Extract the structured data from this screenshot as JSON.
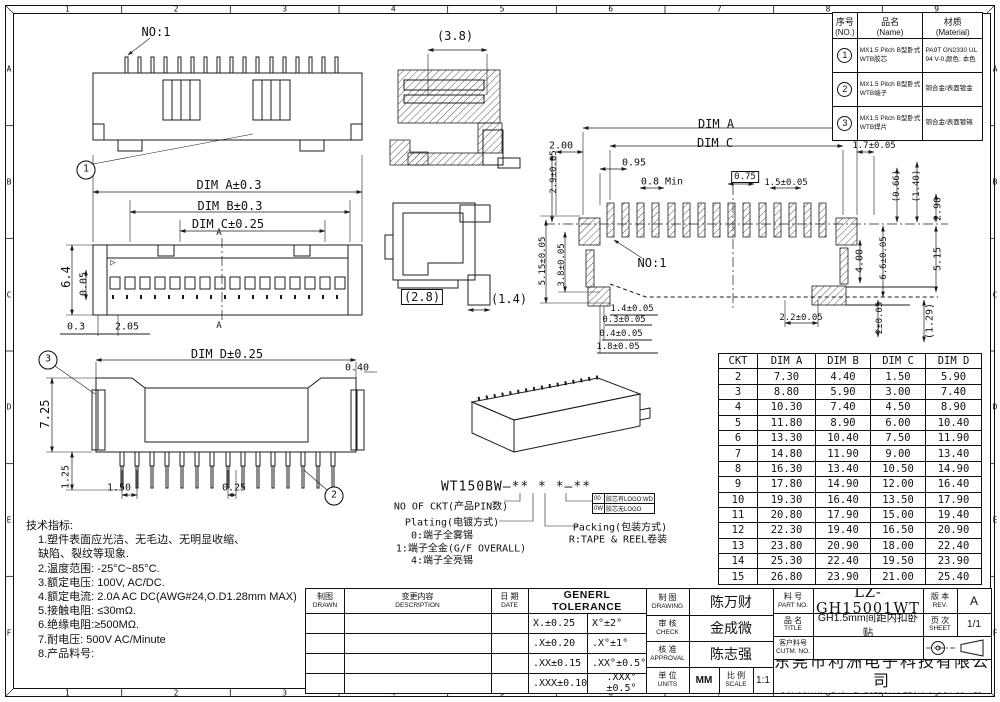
{
  "zones": {
    "cols": [
      "1",
      "2",
      "3",
      "4",
      "5",
      "6",
      "7",
      "8",
      "9"
    ],
    "rows": [
      "A",
      "B",
      "C",
      "D",
      "E",
      "F"
    ]
  },
  "bom": {
    "no_cn": "序号",
    "no_en": "(NO.)",
    "name_cn": "品名",
    "name_en": "(Name)",
    "mat_cn": "材质",
    "mat_en": "(Material)",
    "rows": [
      {
        "no": "1",
        "name": "MX1.5 Pitch B型卧式 WTB胶芯",
        "mat": "PA9T GN2330 UL 94 V-0,颜色: 本色"
      },
      {
        "no": "2",
        "name": "MX1.5 Pitch B型卧式 WTB端子",
        "mat": "铜合金/表面镀金"
      },
      {
        "no": "3",
        "name": "MX1.5 Pitch B型卧式 WTB焊片",
        "mat": "铜合金/表面镀锡"
      }
    ]
  },
  "dim_table": {
    "headers": [
      "CKT",
      "DIM A",
      "DIM B",
      "DIM C",
      "DIM D"
    ],
    "rows": [
      [
        "2",
        "7.30",
        "4.40",
        "1.50",
        "5.90"
      ],
      [
        "3",
        "8.80",
        "5.90",
        "3.00",
        "7.40"
      ],
      [
        "4",
        "10.30",
        "7.40",
        "4.50",
        "8.90"
      ],
      [
        "5",
        "11.80",
        "8.90",
        "6.00",
        "10.40"
      ],
      [
        "6",
        "13.30",
        "10.40",
        "7.50",
        "11.90"
      ],
      [
        "7",
        "14.80",
        "11.90",
        "9.00",
        "13.40"
      ],
      [
        "8",
        "16.30",
        "13.40",
        "10.50",
        "14.90"
      ],
      [
        "9",
        "17.80",
        "14.90",
        "12.00",
        "16.40"
      ],
      [
        "10",
        "19.30",
        "16.40",
        "13.50",
        "17.90"
      ],
      [
        "11",
        "20.80",
        "17.90",
        "15.00",
        "19.40"
      ],
      [
        "12",
        "22.30",
        "19.40",
        "16.50",
        "20.90"
      ],
      [
        "13",
        "23.80",
        "20.90",
        "18.00",
        "22.40"
      ],
      [
        "14",
        "25.30",
        "22.40",
        "19.50",
        "23.90"
      ],
      [
        "15",
        "26.80",
        "23.90",
        "21.00",
        "25.40"
      ]
    ]
  },
  "tech_notes": {
    "lines": [
      "技术指标:",
      "1.塑件表面应光洁、无毛边、无明显收缩、",
      "缺陷、裂纹等现象.",
      "2.温度范围: -25°C~85°C.",
      "3.额定电压: 100V, AC/DC.",
      "4.额定电流: 2.0A AC DC(AWG#24,O.D1.28mm MAX)",
      "5.接触电阻: ≤30mΩ.",
      "6.绝缘电阻:≥500MΩ.",
      "7.耐电压: 500V AC/Minute",
      "8.产品料号:"
    ]
  },
  "part_code": {
    "logo_rows": [
      [
        "00",
        "胶芯有LOGO:WD"
      ],
      [
        "0W",
        "胶芯无LOGO"
      ]
    ]
  },
  "rev_block": {
    "drawn_cn": "制图",
    "drawn_en": "DRAWN",
    "desc_cn": "变更内容",
    "desc_en": "DESCRIPTION",
    "date_cn": "日 期",
    "date_en": "DATE"
  },
  "tolerance": {
    "title": "GENERL TOLERANCE",
    "rows": [
      [
        "X.±0.25",
        "X°±2°"
      ],
      [
        ".X±0.20",
        ".X°±1°"
      ],
      [
        ".XX±0.15",
        ".XX°±0.5°"
      ],
      [
        ".XXX±0.10",
        ".XXX°±0.5°"
      ]
    ]
  },
  "approvals": {
    "drawing_cn": "制 图",
    "drawing_en": "DRAWING",
    "drawing_name": "陈万财",
    "check_cn": "审 核",
    "check_en": "CHECK",
    "check_name": "金成微",
    "approval_cn": "核 准",
    "approval_en": "APPROVAL",
    "approval_name": "陈志强",
    "units_cn": "单 位",
    "units_en": "UNITS",
    "units_val": "MM",
    "scale_cn": "比 例",
    "scale_en": "SCALE",
    "scale_val": "1:1"
  },
  "part_info": {
    "part_no_cn": "料 号",
    "part_no_en": "PART NO.",
    "part_no": "LZ-GH15001WT",
    "title_cn": "品 名",
    "title_en": "TITLE",
    "title": "GH1.5mm间距内扣卧贴",
    "cust_cn": "客户料号",
    "cust_en": "CUTM. NO.",
    "cust_val": "",
    "rev_cn": "版 本",
    "rev_en": "REV.",
    "rev": "A",
    "sheet_cn": "页 次",
    "sheet_en": "SHEET",
    "sheet": "1/1",
    "company_cn": "东莞市利洲电子科技有限公司",
    "company_en": "DONGGUAN LIZHOU EL ECTRONIC TECHNOLOGY CO.,LTD"
  },
  "annotations": [
    {
      "t": "NO:1",
      "x": 156,
      "y": 32
    },
    {
      "t": "1",
      "x": 86,
      "y": 170,
      "c": "circ",
      "n": "balloon-1"
    },
    {
      "t": "DIM A±0.3",
      "x": 229,
      "y": 185
    },
    {
      "t": "DIM B±0.3",
      "x": 230,
      "y": 206
    },
    {
      "t": "DIM C±0.25",
      "x": 228,
      "y": 224
    },
    {
      "t": "A",
      "x": 219,
      "y": 233,
      "c": "xs"
    },
    {
      "t": "A",
      "x": 219,
      "y": 326,
      "c": "xs"
    },
    {
      "t": "▷",
      "x": 113,
      "y": 263,
      "c": "xs"
    },
    {
      "t": "6.4",
      "x": 66,
      "y": 277,
      "r": -90
    },
    {
      "t": "0.05",
      "x": 84,
      "y": 284,
      "r": -90,
      "c": "sm"
    },
    {
      "t": "0.3",
      "x": 76,
      "y": 327,
      "c": "sm"
    },
    {
      "t": "2.05",
      "x": 127,
      "y": 327,
      "c": "sm"
    },
    {
      "t": "3",
      "x": 48,
      "y": 360,
      "c": "circ",
      "n": "balloon-3"
    },
    {
      "t": "DIM D±0.25",
      "x": 227,
      "y": 354
    },
    {
      "t": "0.40",
      "x": 357,
      "y": 368,
      "c": "sm"
    },
    {
      "t": "7.25",
      "x": 45,
      "y": 414,
      "r": -90
    },
    {
      "t": "1.25",
      "x": 66,
      "y": 477,
      "r": -90,
      "c": "sm"
    },
    {
      "t": "1.50",
      "x": 119,
      "y": 488,
      "c": "sm"
    },
    {
      "t": "0.25",
      "x": 234,
      "y": 488,
      "c": "sm"
    },
    {
      "t": "2",
      "x": 334,
      "y": 496,
      "c": "circ",
      "n": "balloon-2"
    },
    {
      "t": "(3.8)",
      "x": 455,
      "y": 36
    },
    {
      "t": "(2.8)",
      "x": 422,
      "y": 297,
      "c": "box"
    },
    {
      "t": "(1.4)",
      "x": 509,
      "y": 299
    },
    {
      "t": "DIM A",
      "x": 716,
      "y": 124
    },
    {
      "t": "DIM C",
      "x": 715,
      "y": 143
    },
    {
      "t": "2.00",
      "x": 561,
      "y": 146,
      "c": "sm"
    },
    {
      "t": "2.9±0.05",
      "x": 554,
      "y": 172,
      "r": -90,
      "c": "xs"
    },
    {
      "t": "0.95",
      "x": 634,
      "y": 163,
      "c": "sm"
    },
    {
      "t": "0.8 Min",
      "x": 662,
      "y": 182,
      "c": "sm"
    },
    {
      "t": "0.75",
      "x": 745,
      "y": 177,
      "c": "box xs"
    },
    {
      "t": "1.5±0.05",
      "x": 786,
      "y": 183,
      "c": "xs"
    },
    {
      "t": "1.7±0.05",
      "x": 874,
      "y": 146,
      "c": "xs"
    },
    {
      "t": "(0.66)",
      "x": 897,
      "y": 186,
      "r": -90,
      "c": "xs"
    },
    {
      "t": "(1.40)",
      "x": 917,
      "y": 186,
      "r": -90,
      "c": "xs"
    },
    {
      "t": "2.90",
      "x": 938,
      "y": 209,
      "r": -90,
      "c": "sm"
    },
    {
      "t": "5.15±0.05",
      "x": 543,
      "y": 261,
      "r": -90,
      "c": "xs"
    },
    {
      "t": "3.8±0.05",
      "x": 562,
      "y": 265,
      "r": -90,
      "c": "xs"
    },
    {
      "t": "NO:1",
      "x": 652,
      "y": 263
    },
    {
      "t": "4.00",
      "x": 860,
      "y": 261,
      "r": -90,
      "c": "sm"
    },
    {
      "t": "6.6±0.05",
      "x": 884,
      "y": 258,
      "r": -90,
      "c": "xs"
    },
    {
      "t": "5.15",
      "x": 938,
      "y": 259,
      "r": -90,
      "c": "sm"
    },
    {
      "t": "1.4±0.05",
      "x": 632,
      "y": 309,
      "c": "xs"
    },
    {
      "t": "0.3±0.05",
      "x": 624,
      "y": 320,
      "c": "xs"
    },
    {
      "t": "0.4±0.05",
      "x": 621,
      "y": 334,
      "c": "xs"
    },
    {
      "t": "1.8±0.05",
      "x": 618,
      "y": 347,
      "c": "xs"
    },
    {
      "t": "2.2±0.05",
      "x": 801,
      "y": 318,
      "c": "xs"
    },
    {
      "t": "2±0.05",
      "x": 880,
      "y": 318,
      "r": -90,
      "c": "xs"
    },
    {
      "t": "(1.29)",
      "x": 930,
      "y": 321,
      "r": -90,
      "c": "sm"
    },
    {
      "t": "WT150BW—** * *—**",
      "x": 516,
      "y": 487,
      "c": "pn"
    },
    {
      "t": "NO OF CKT(产品PIN数)",
      "x": 451,
      "y": 505,
      "c": "sm"
    },
    {
      "t": "Plating(电镀方式)",
      "x": 452,
      "y": 521,
      "c": "sm"
    },
    {
      "t": "0:端子全雾锡",
      "x": 442,
      "y": 534,
      "c": "sm"
    },
    {
      "t": "1:端子全金(G/F OVERALL)",
      "x": 461,
      "y": 547,
      "c": "sm"
    },
    {
      "t": "4:端子全亮锡",
      "x": 442,
      "y": 559,
      "c": "sm"
    },
    {
      "t": "Packing(包装方式)",
      "x": 620,
      "y": 526,
      "c": "sm"
    },
    {
      "t": "R:TAPE & REEL卷装",
      "x": 618,
      "y": 538,
      "c": "sm"
    }
  ]
}
